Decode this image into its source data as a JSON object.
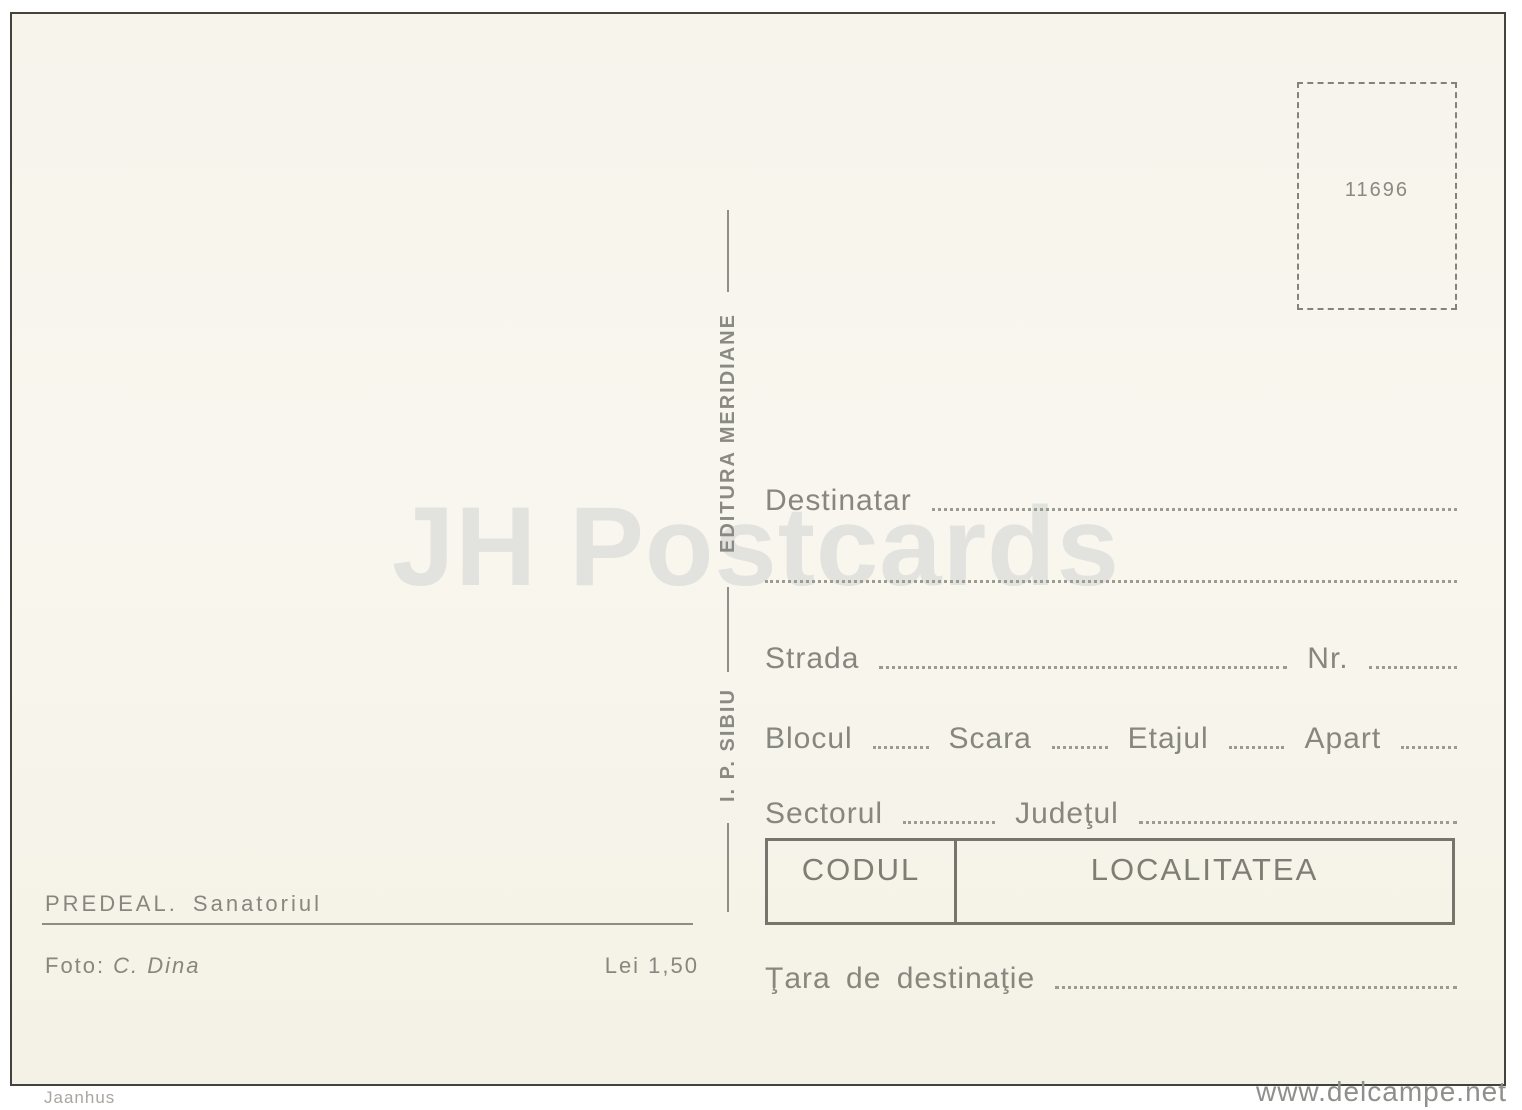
{
  "postcard": {
    "watermark_center": "JH Postcards",
    "stamp_box": {
      "catalog_number": "11696"
    },
    "publisher": {
      "name": "EDITURA MERIDIANE",
      "printer": "I. P. SIBIU"
    },
    "address_form": {
      "destinatar": "Destinatar",
      "strada": "Strada",
      "nr": "Nr.",
      "blocul": "Blocul",
      "scara": "Scara",
      "etajul": "Etajul",
      "apart": "Apart",
      "sectorul": "Sectorul",
      "judetul": "Judeţul",
      "codul": "CODUL",
      "localitatea": "LOCALITATEA",
      "tara": "Ţara de destinaţie"
    },
    "caption": {
      "title": "PREDEAL. Sanatoriul",
      "photo_label": "Foto:",
      "photographer": "C. Dina",
      "price": "Lei 1,50"
    },
    "colors": {
      "card_background": "#f6f4eb",
      "ink_gray": "#87877f",
      "table_border": "#75756d",
      "watermark_gray": "#e2e2de",
      "scan_border": "#43423d"
    }
  },
  "page": {
    "watermark_bottom_left": "Jaanhus",
    "watermark_bottom_right": "www.delcampe.net"
  }
}
